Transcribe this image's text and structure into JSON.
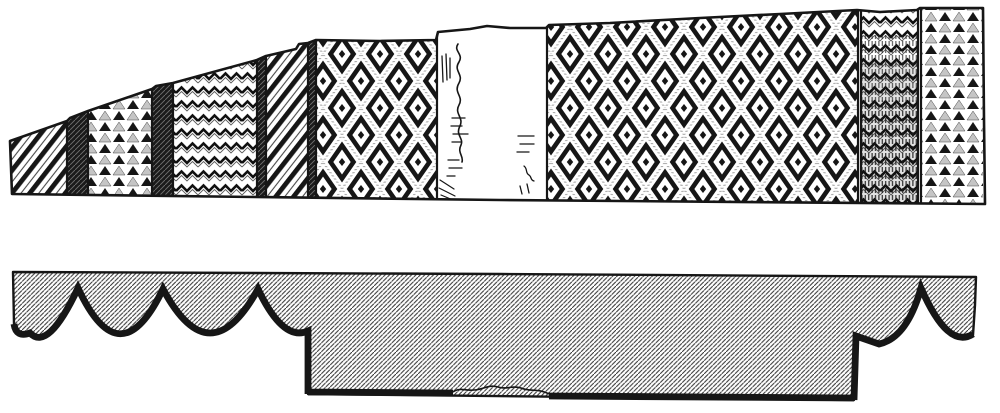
{
  "figure": {
    "name": "engraved-patterned-band-with-section-profile",
    "ink_color": "#161616",
    "paper_color": "#ffffff",
    "elevation": {
      "band_outline_d": "M10,141 L67,121 L70,118 L88,111 L152,89 L156,86 L173,83 L257,60 L266,56 L296,49 L299,44 L308,43 L316,40 L380,41 L436,40 L438,32 L470,29 L487,26 L510,28 L546,28 L549,25 L610,23 L700,18 L780,14 L857,10 L880,12 L917,10 L920,8 L983,8 L984,120 L985,204 L500,200 L12,194 Z",
      "sections": [
        {
          "name": "panel-diagonal-stripes-left",
          "x1": 10,
          "x2": 67,
          "pattern": "diagonal-stripes"
        },
        {
          "name": "divider-band-1",
          "x1": 67,
          "x2": 88,
          "pattern": "dense-hatch"
        },
        {
          "name": "panel-triangles-left",
          "x1": 88,
          "x2": 152,
          "pattern": "triangle-rows"
        },
        {
          "name": "divider-band-2",
          "x1": 152,
          "x2": 173,
          "pattern": "dense-hatch"
        },
        {
          "name": "panel-zigzag-left",
          "x1": 173,
          "x2": 257,
          "pattern": "zigzag-rows"
        },
        {
          "name": "divider-band-3",
          "x1": 257,
          "x2": 266,
          "pattern": "dense-hatch"
        },
        {
          "name": "panel-diagonal-stripes-mid",
          "x1": 266,
          "x2": 308,
          "pattern": "diagonal-stripes"
        },
        {
          "name": "divider-band-4",
          "x1": 308,
          "x2": 316,
          "pattern": "dense-hatch"
        },
        {
          "name": "panel-diamonds-left",
          "x1": 316,
          "x2": 437,
          "pattern": "diamond-diaper"
        },
        {
          "name": "panel-worn-blank",
          "x1": 437,
          "x2": 547,
          "pattern": "paper"
        },
        {
          "name": "panel-diamonds-right",
          "x1": 547,
          "x2": 858,
          "pattern": "diamond-diaper"
        },
        {
          "name": "panel-zigzag-right",
          "x1": 861,
          "x2": 918,
          "pattern": "zigzag-shaded"
        },
        {
          "name": "panel-triangles-right",
          "x1": 921,
          "x2": 983,
          "pattern": "triangle-rows"
        }
      ],
      "boundaries": [
        67,
        88,
        152,
        173,
        257,
        266,
        308,
        316,
        437,
        547,
        858,
        861,
        918,
        921
      ],
      "worn_marks": [
        {
          "name": "worn-hatch-top-left",
          "d": "M442,56 L443,82 M446,54 L447,80 M450,58 L450,78",
          "w": 1.3
        },
        {
          "name": "worn-squiggle-vertical",
          "d": "M458,44 c-5,7 6,10 1,18 c-6,9 5,12 0,21 c-6,10 5,13 0,22 c-5,9 5,12 1,21 c-5,9 4,12 1,19 c-4,8 3,11 1,17",
          "w": 1.6
        },
        {
          "name": "worn-dashes-mid-left",
          "d": "M452,118 h13 M451,126 h11 M453,134 h15 M452,142 h9",
          "w": 1.3
        },
        {
          "name": "worn-dashes-lower-left",
          "d": "M448,160 h11 M449,168 h13 M447,176 h8",
          "w": 1.3
        },
        {
          "name": "worn-strokes-right",
          "d": "M518,136 h16 M520,144 h14 M517,152 h12",
          "w": 1.3
        },
        {
          "name": "worn-curl-right",
          "d": "M524,166 c4,3 1,7 5,9 c3,2 1,5 5,6 M520,186 l2,8 M527,184 l2,9",
          "w": 1.3
        },
        {
          "name": "worn-shade-bottom-left",
          "d": "M440,180 l14,9 M439,188 l16,8 M441,195 l12,5",
          "w": 1.2
        }
      ]
    },
    "section_profile": {
      "outline_d": "M13,272 L500,274 L976,277 L975,305 L973,335 Q948,350 921,288 L921,287 Q907,338 879,344 L856,336 L854,400 L308,394 L308,331 Q283,342 258,289 L258,288 Q210,377 163,289 L163,288 Q120,379 78,288 Q48,352 30,333 Q16,338 14,324 Z",
      "underside_d": "M973,334 Q948,350 921,288 Q907,338 879,344 L856,336 L854,400 M854,398 L549,396 M453,393 L308,392 M308,394 L308,331 Q283,342 258,289 Q210,377 163,289 Q120,379 78,288 Q48,352 30,333 Q16,338 14,324",
      "damaged_gap_d": "M549,394 C538,388 530,392 521,388 C512,385 506,390 498,387 C489,384 482,390 474,390 C466,391 460,387 453,392",
      "scallop_cusps_x": [
        78,
        163,
        258,
        921
      ],
      "deep_recess": {
        "x1": 308,
        "x2": 854,
        "bottom_left_y": 394,
        "bottom_right_y": 400,
        "damaged_gap_x": [
          453,
          549
        ]
      }
    }
  }
}
